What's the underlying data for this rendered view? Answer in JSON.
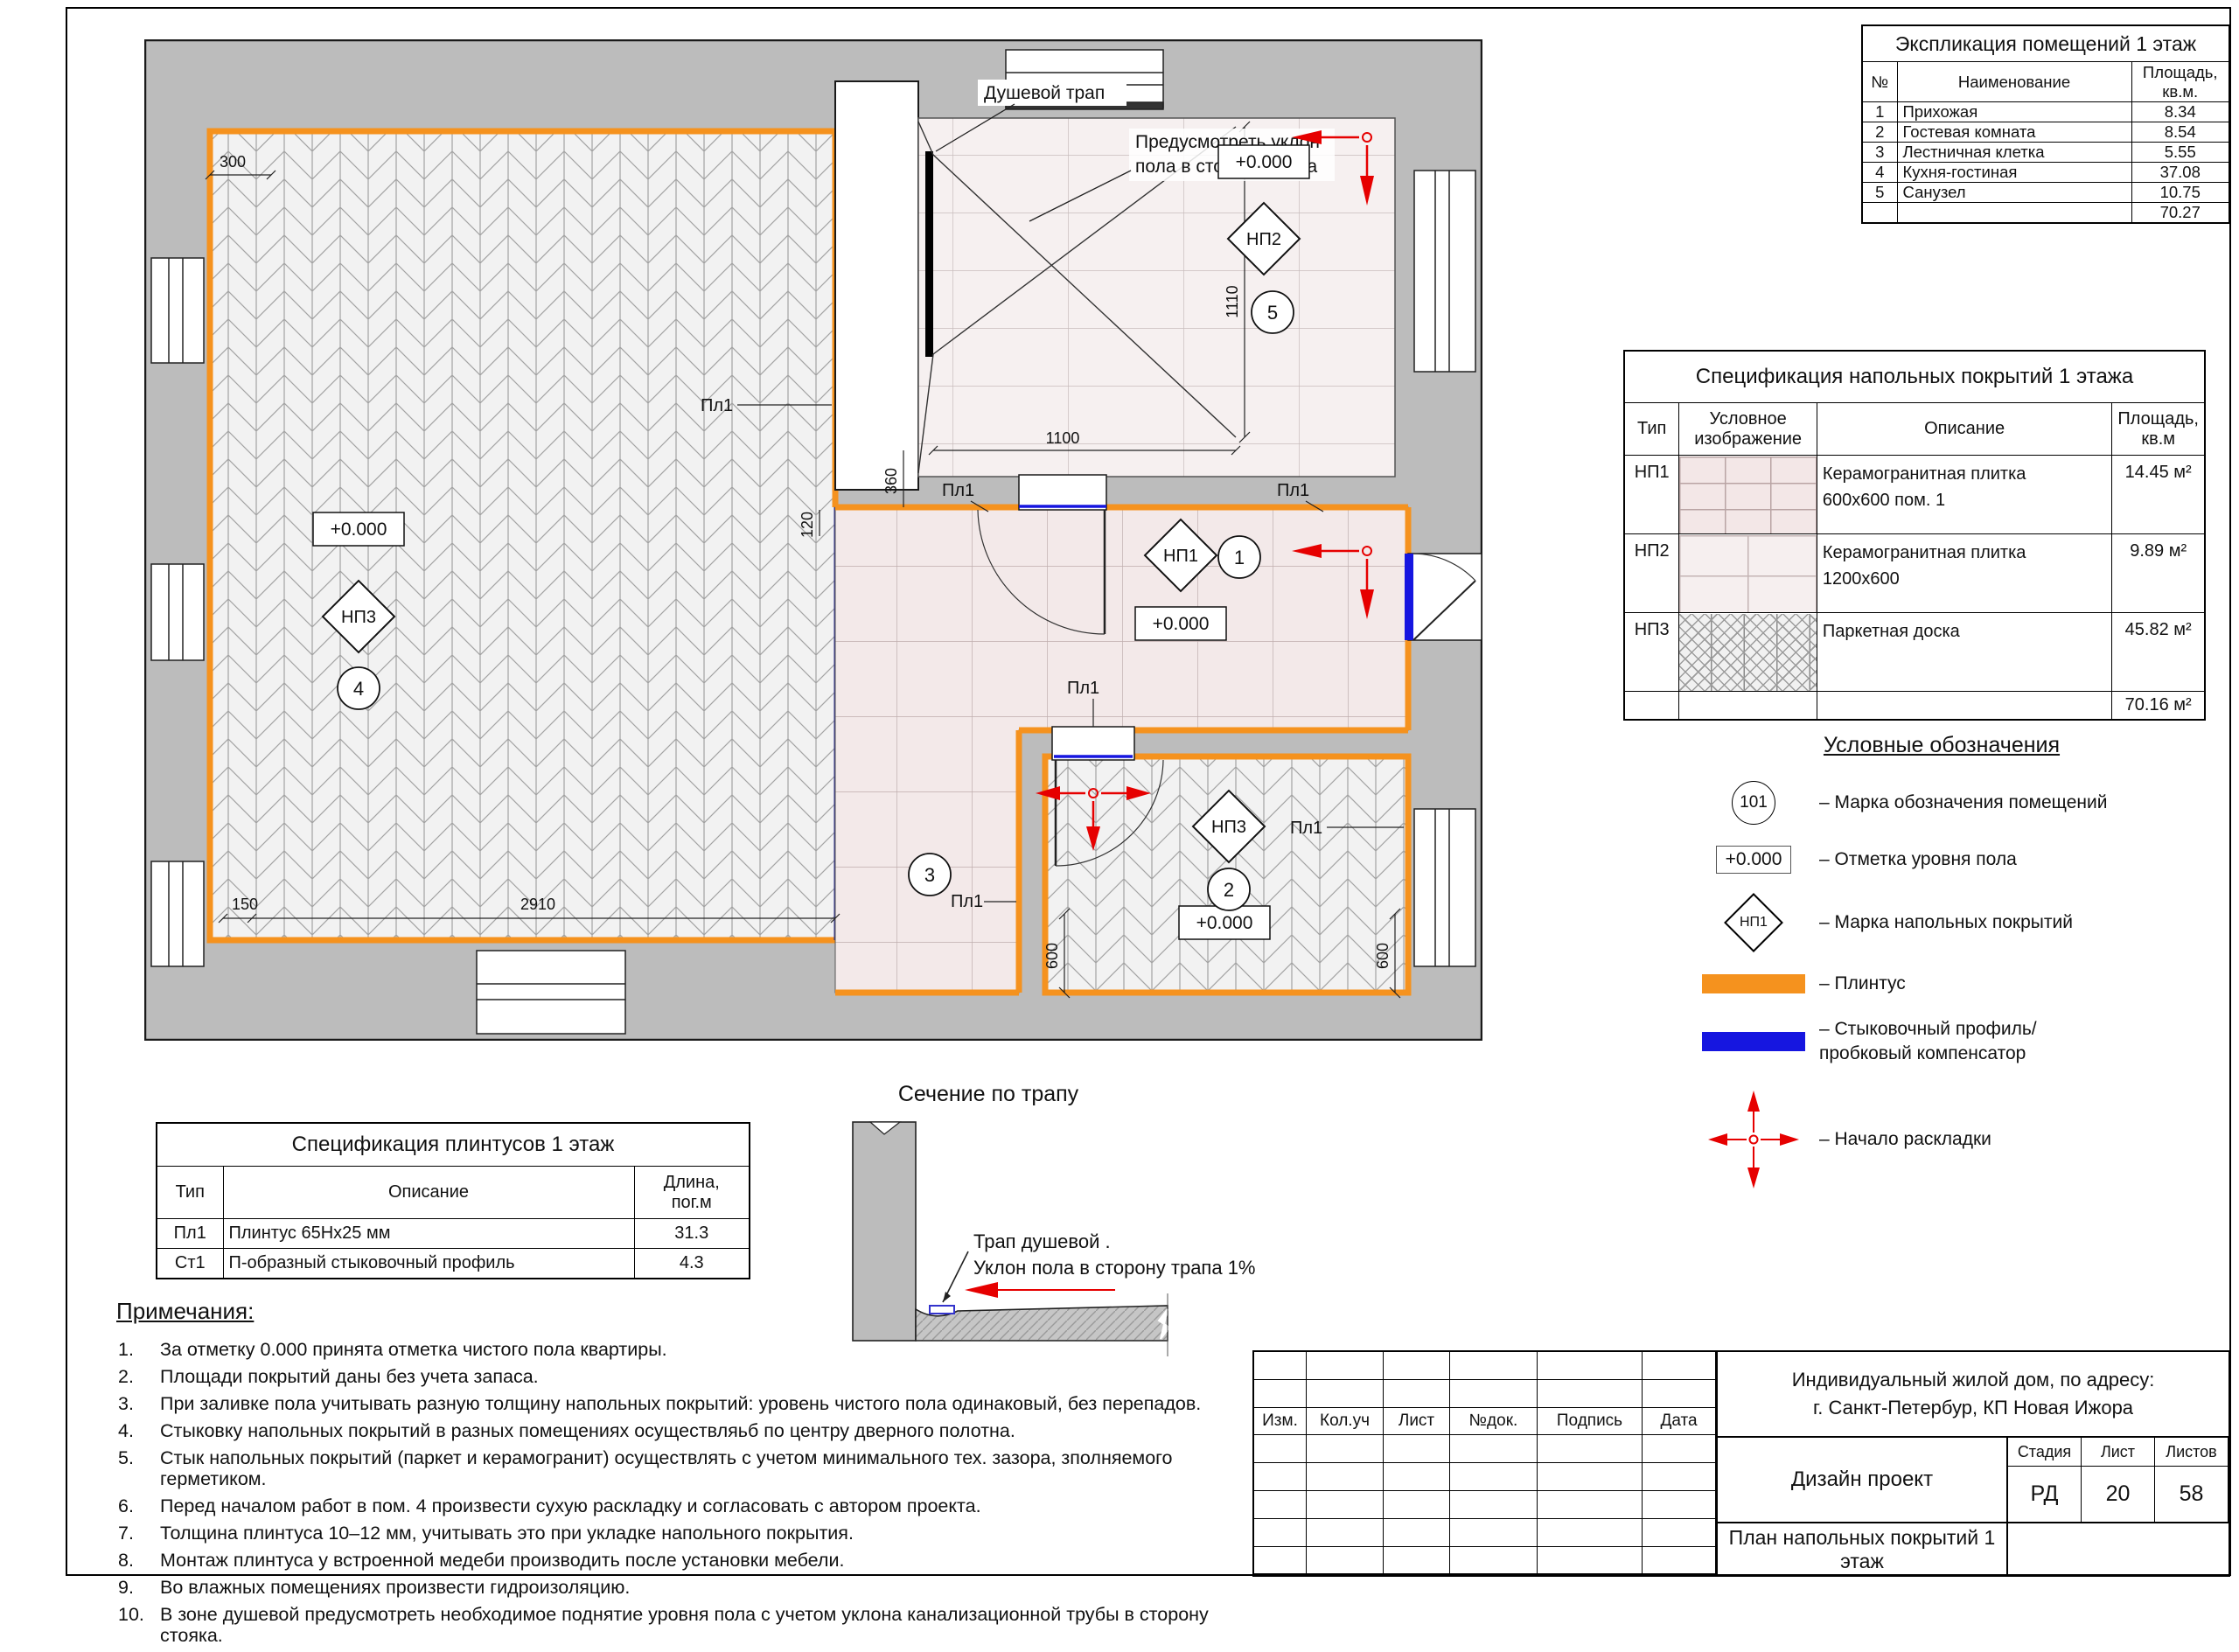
{
  "plan": {
    "pl1": "Пл1",
    "level": "+0.000",
    "marks": {
      "np1": "НП1",
      "np2": "НП2",
      "np3": "НП3"
    },
    "rooms": {
      "r1": "1",
      "r2": "2",
      "r3": "3",
      "r4": "4",
      "r5": "5"
    },
    "dims": {
      "d300": "300",
      "d1110": "1110",
      "d1100": "1100",
      "d360": "360",
      "d120": "120",
      "d150": "150",
      "d2910": "2910",
      "d600": "600"
    },
    "shower": {
      "trap": "Душевой трап",
      "slope1": "Предусмотреть уклон",
      "slope2": "пола в сторону трапа"
    }
  },
  "tables": {
    "explication": {
      "title": "Экспликация помещений 1 этаж",
      "h_num": "№",
      "h_name": "Наименование",
      "h_area1": "Площадь,",
      "h_area2": "кв.м.",
      "rows": [
        [
          "1",
          "Прихожая",
          "8.34"
        ],
        [
          "2",
          "Гостевая комната",
          "8.54"
        ],
        [
          "3",
          "Лестничная клетка",
          "5.55"
        ],
        [
          "4",
          "Кухня-гостиная",
          "37.08"
        ],
        [
          "5",
          "Санузел",
          "10.75"
        ]
      ],
      "total": "70.27"
    },
    "floor_spec": {
      "title": "Спецификация напольных покрытий 1 этажа",
      "h_type": "Тип",
      "h_img1": "Условное",
      "h_img2": "изображение",
      "h_desc": "Описание",
      "h_area1": "Площадь,",
      "h_area2": "кв.м",
      "rows": [
        {
          "type": "НП1",
          "desc1": "Керамогранитная плитка",
          "desc2": "600х600 пом. 1",
          "area": "14.45 м²"
        },
        {
          "type": "НП2",
          "desc1": "Керамогранитная плитка",
          "desc2": "1200х600",
          "area": "9.89 м²"
        },
        {
          "type": "НП3",
          "desc1": "Паркетная доска",
          "desc2": "",
          "area": "45.82 м²"
        }
      ],
      "total": "70.16 м²"
    },
    "plinth_spec": {
      "title": "Спецификация плинтусов 1 этаж",
      "h_type": "Тип",
      "h_desc": "Описание",
      "h_len1": "Длина,",
      "h_len2": "пог.м",
      "rows": [
        {
          "type": "Пл1",
          "desc": "Плинтус 65Нх25 мм",
          "len": "31.3"
        },
        {
          "type": "Ст1",
          "desc": "П-образный стыковочный профиль",
          "len": "4.3"
        }
      ]
    }
  },
  "legend": {
    "title": "Условные обозначения",
    "room_glyph": "101",
    "room_label": "– Марка обозначения помещений",
    "level_glyph": "+0.000",
    "level_label": "– Отметка уровня пола",
    "floor_glyph": "НП1",
    "floor_label": "– Марка напольных покрытий",
    "plinth_label": "– Плинтус",
    "profile_label1": "– Стыковочный профиль/",
    "profile_label2": "пробковый компенсатор",
    "layout_label": "– Начало раскладки"
  },
  "section": {
    "title": "Сечение по трапу",
    "label1": "Трап душевой .",
    "label2": "Уклон пола в сторону трапа 1%"
  },
  "notes": {
    "title": "Примечания:",
    "items": [
      {
        "n": "1.",
        "t": "За отметку 0.000 принята отметка чистого пола квартиры."
      },
      {
        "n": "2.",
        "t": "Площади покрытий даны без учета запаса."
      },
      {
        "n": "3.",
        "t": "При заливке пола учитывать разную толщину напольных покрытий: уровень чистого пола одинаковый, без перепадов."
      },
      {
        "n": "4.",
        "t": "Стыковку напольных покрытий в разных помещениях осуществляьб по центру дверного полотна."
      },
      {
        "n": "5.",
        "t": "Стык напольных покрытий (паркет и керамогранит) осуществлять с учетом минимального тех. зазора, зполняемого герметиком."
      },
      {
        "n": "6.",
        "t": "Перед началом работ в пом. 4 произвести сухую раскладку и согласовать с автором проекта."
      },
      {
        "n": "7.",
        "t": "Толщина плинтуса 10–12 мм, учитывать это при укладке напольного покрытия."
      },
      {
        "n": "8.",
        "t": "Монтаж плинтуса у встроенной медеби производить после установки мебели."
      },
      {
        "n": "9.",
        "t": "Во влажных помещениях произвести гидроизоляцию."
      },
      {
        "n": "10.",
        "t": "В зоне душевой предусмотреть необходимое поднятие уровня пола с учетом уклона канализационной трубы в сторону стояка."
      }
    ]
  },
  "titleblock": {
    "address1": "Индивидуальный жилой дом, по адресу:",
    "address2": "г. Санкт-Петербур, КП Новая Ижора",
    "c_izm": "Изм.",
    "c_kol": "Кол.уч",
    "c_list": "Лист",
    "c_ndok": "№док.",
    "c_podp": "Подпись",
    "c_data": "Дата",
    "project": "Дизайн проект",
    "h_stage": "Стадия",
    "h_sheet": "Лист",
    "h_sheets": "Листов",
    "stage": "РД",
    "sheet": "20",
    "sheets": "58",
    "drawing": "План напольных покрытий 1 этаж"
  }
}
